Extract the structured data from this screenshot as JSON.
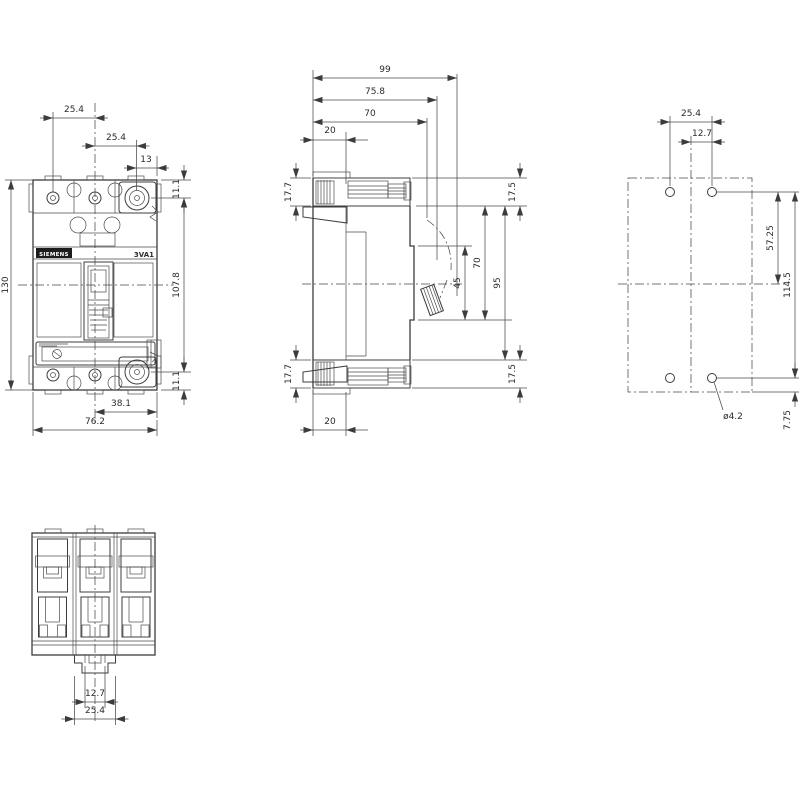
{
  "drawing": {
    "front": {
      "brand": "SIEMENS",
      "model": "3VA1",
      "dims": {
        "pole_pitch_1": "25.4",
        "pole_pitch_2": "25.4",
        "pole_to_edge": "13",
        "top_offset": "11.1",
        "inner_height": "107.8",
        "bottom_offset": "11.1",
        "overall_height": "130",
        "center_to_edge": "38.1",
        "overall_width": "76.2"
      }
    },
    "side": {
      "dims": {
        "overall_depth": "99",
        "depth_to_handle": "75.8",
        "body_depth": "70",
        "terminal_depth_top": "20",
        "terminal_height_top": "17.7",
        "top_margin": "17.5",
        "handle_window": "45",
        "front_height": "70",
        "body_height": "95",
        "bottom_margin": "17.5",
        "terminal_height_bottom": "17.7",
        "terminal_depth_bottom": "20"
      }
    },
    "drill": {
      "dims": {
        "hole_pitch_x": "25.4",
        "hole_to_center": "12.7",
        "hole_to_mid": "57.25",
        "hole_pitch_y": "114.5",
        "hole_diameter": "ø4.2",
        "hole_to_edge": "7.75"
      }
    },
    "bottom": {
      "dims": {
        "slot_width": "12.7",
        "foot_width": "25.4"
      }
    }
  }
}
